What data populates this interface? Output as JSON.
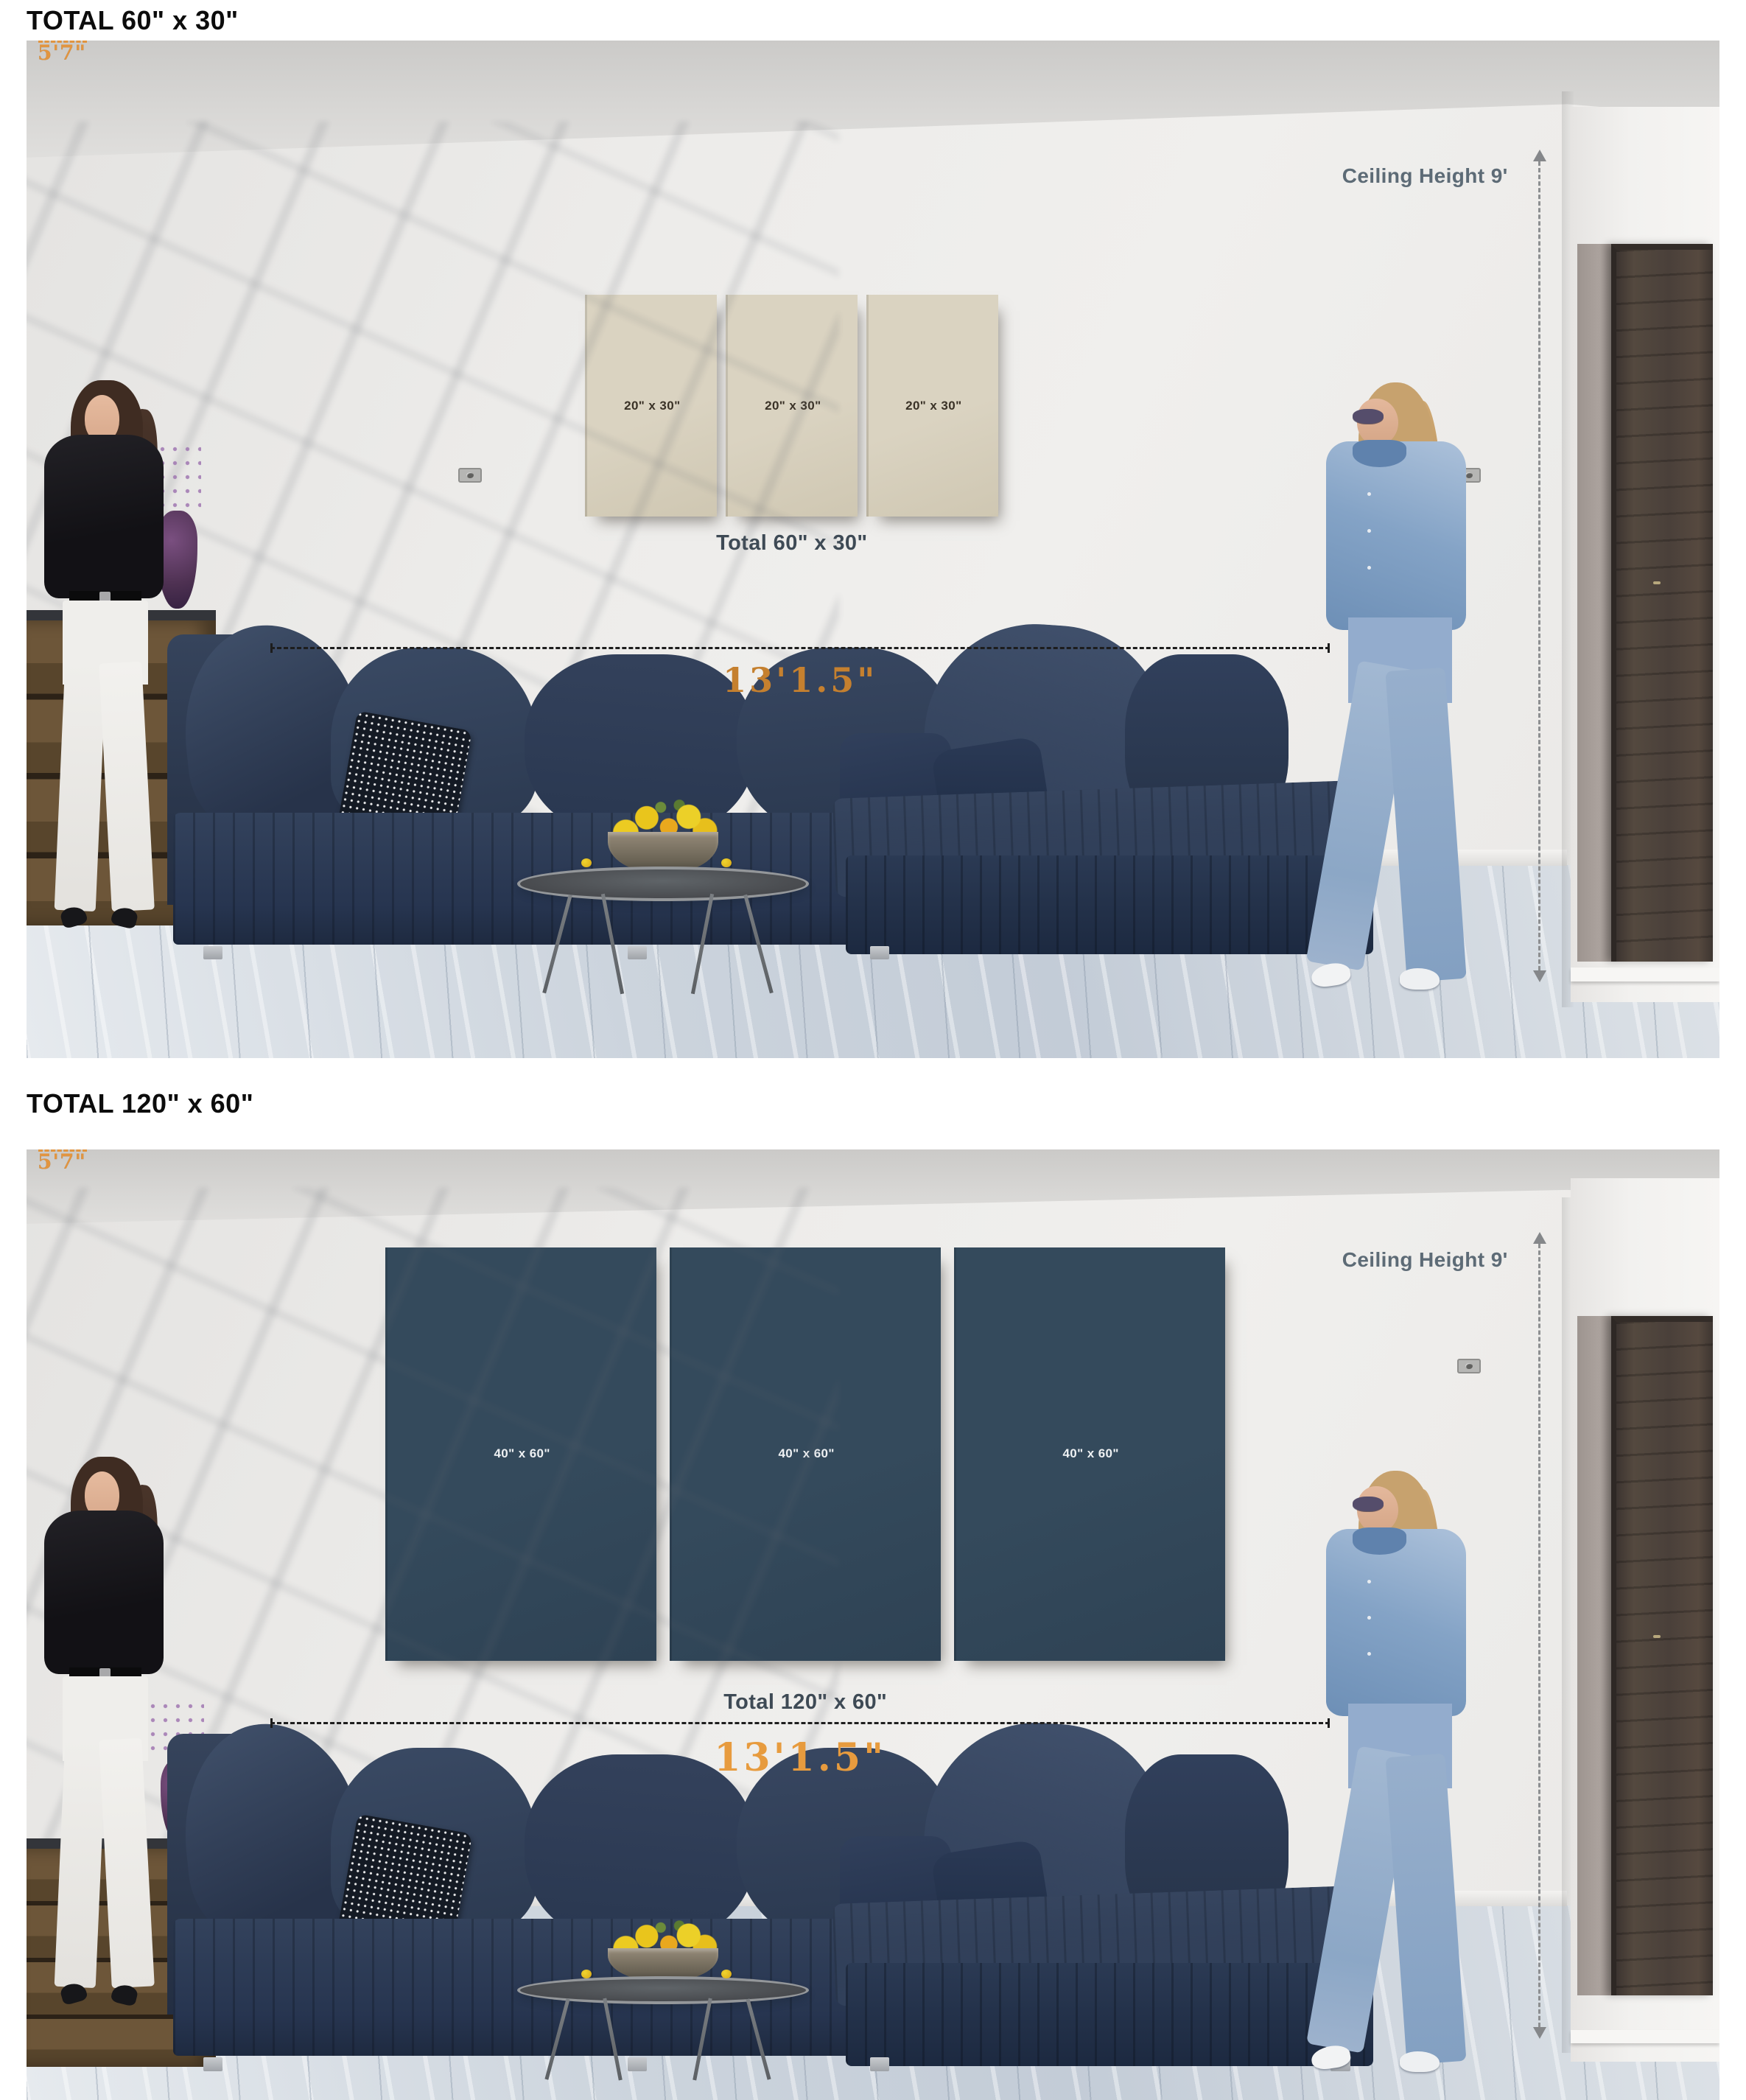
{
  "page": {
    "scene1_title": "TOTAL 60\" x 30\"",
    "scene2_title": "TOTAL 120\" x 60\""
  },
  "scene1": {
    "title": "TOTAL 60\" x 30\"",
    "ceiling_label": "Ceiling Height 9'",
    "left_height_label": "5'7\"",
    "right_height_label": "5'7\"",
    "width_label": "13'1.5\"",
    "panels": [
      "20\" x 30\"",
      "20\" x 30\"",
      "20\" x 30\""
    ],
    "total_label": "Total 60\" x 30\""
  },
  "scene2": {
    "title": "TOTAL 120\" x 60\"",
    "ceiling_label": "Ceiling Height 9'",
    "left_height_label": "5'7\"",
    "right_height_label": "5'7\"",
    "width_label": "13'1.5\"",
    "panels": [
      "40\" x 60\"",
      "40\" x 60\"",
      "40\" x 60\""
    ],
    "total_label": "Total 120\" x 60\""
  },
  "colors": {
    "panel_beige": "#dad3c1",
    "panel_teal": "#344a5c",
    "marker_blue": "#5b84b8",
    "marker_orange": "#e2953f",
    "width_label_orange_1": "#c5802f",
    "width_label_orange_2": "#e79b3e",
    "slate_text": "#5d6b76",
    "total_text": "#3e4a55"
  }
}
